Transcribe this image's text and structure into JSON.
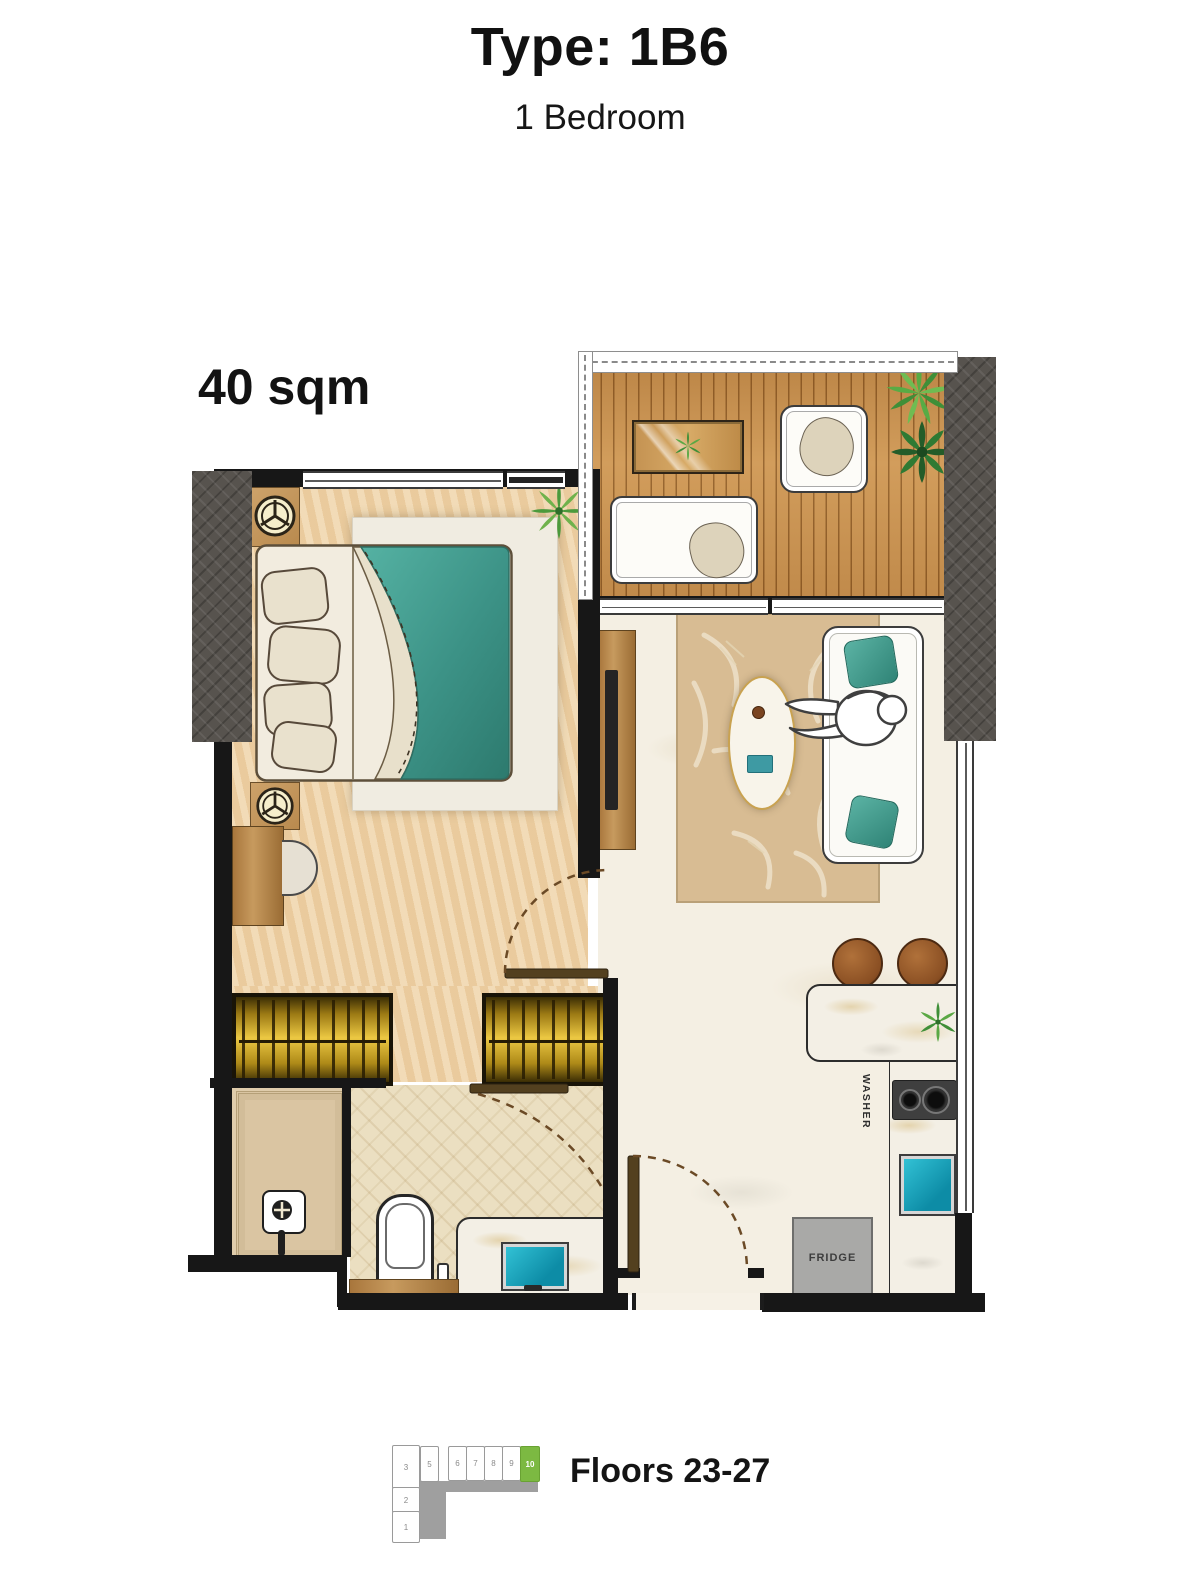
{
  "header": {
    "title": "Type: 1B6",
    "subtitle": "1 Bedroom"
  },
  "plan": {
    "area_label": "40 sqm",
    "appliance_labels": {
      "washer": "WASHER",
      "fridge": "FRIDGE"
    }
  },
  "key_plan": {
    "floors_label": "Floors 23-27",
    "stack_units": [
      "3",
      "2",
      "1"
    ],
    "row_units": [
      "5",
      "6",
      "7",
      "8",
      "9",
      "10"
    ],
    "highlighted_unit": "10",
    "highlight_color": "#7cb942"
  },
  "colors": {
    "wall": "#171717",
    "bedroom_floor": "#edd1a6",
    "balcony_deck": "#cd9654",
    "living_floor": "#f4efe3",
    "bath_floor": "#ebdfc1",
    "facade_gray": "#57534e",
    "wardrobe_gold": "#ecc843",
    "blanket_teal": "#47a093",
    "sink_teal": "#1ab5c9",
    "counter_marble": "#f3efe5",
    "fridge_gray": "#a9a9a7",
    "stool_brown": "#8a4f23",
    "keyplan_green": "#7cb942"
  }
}
